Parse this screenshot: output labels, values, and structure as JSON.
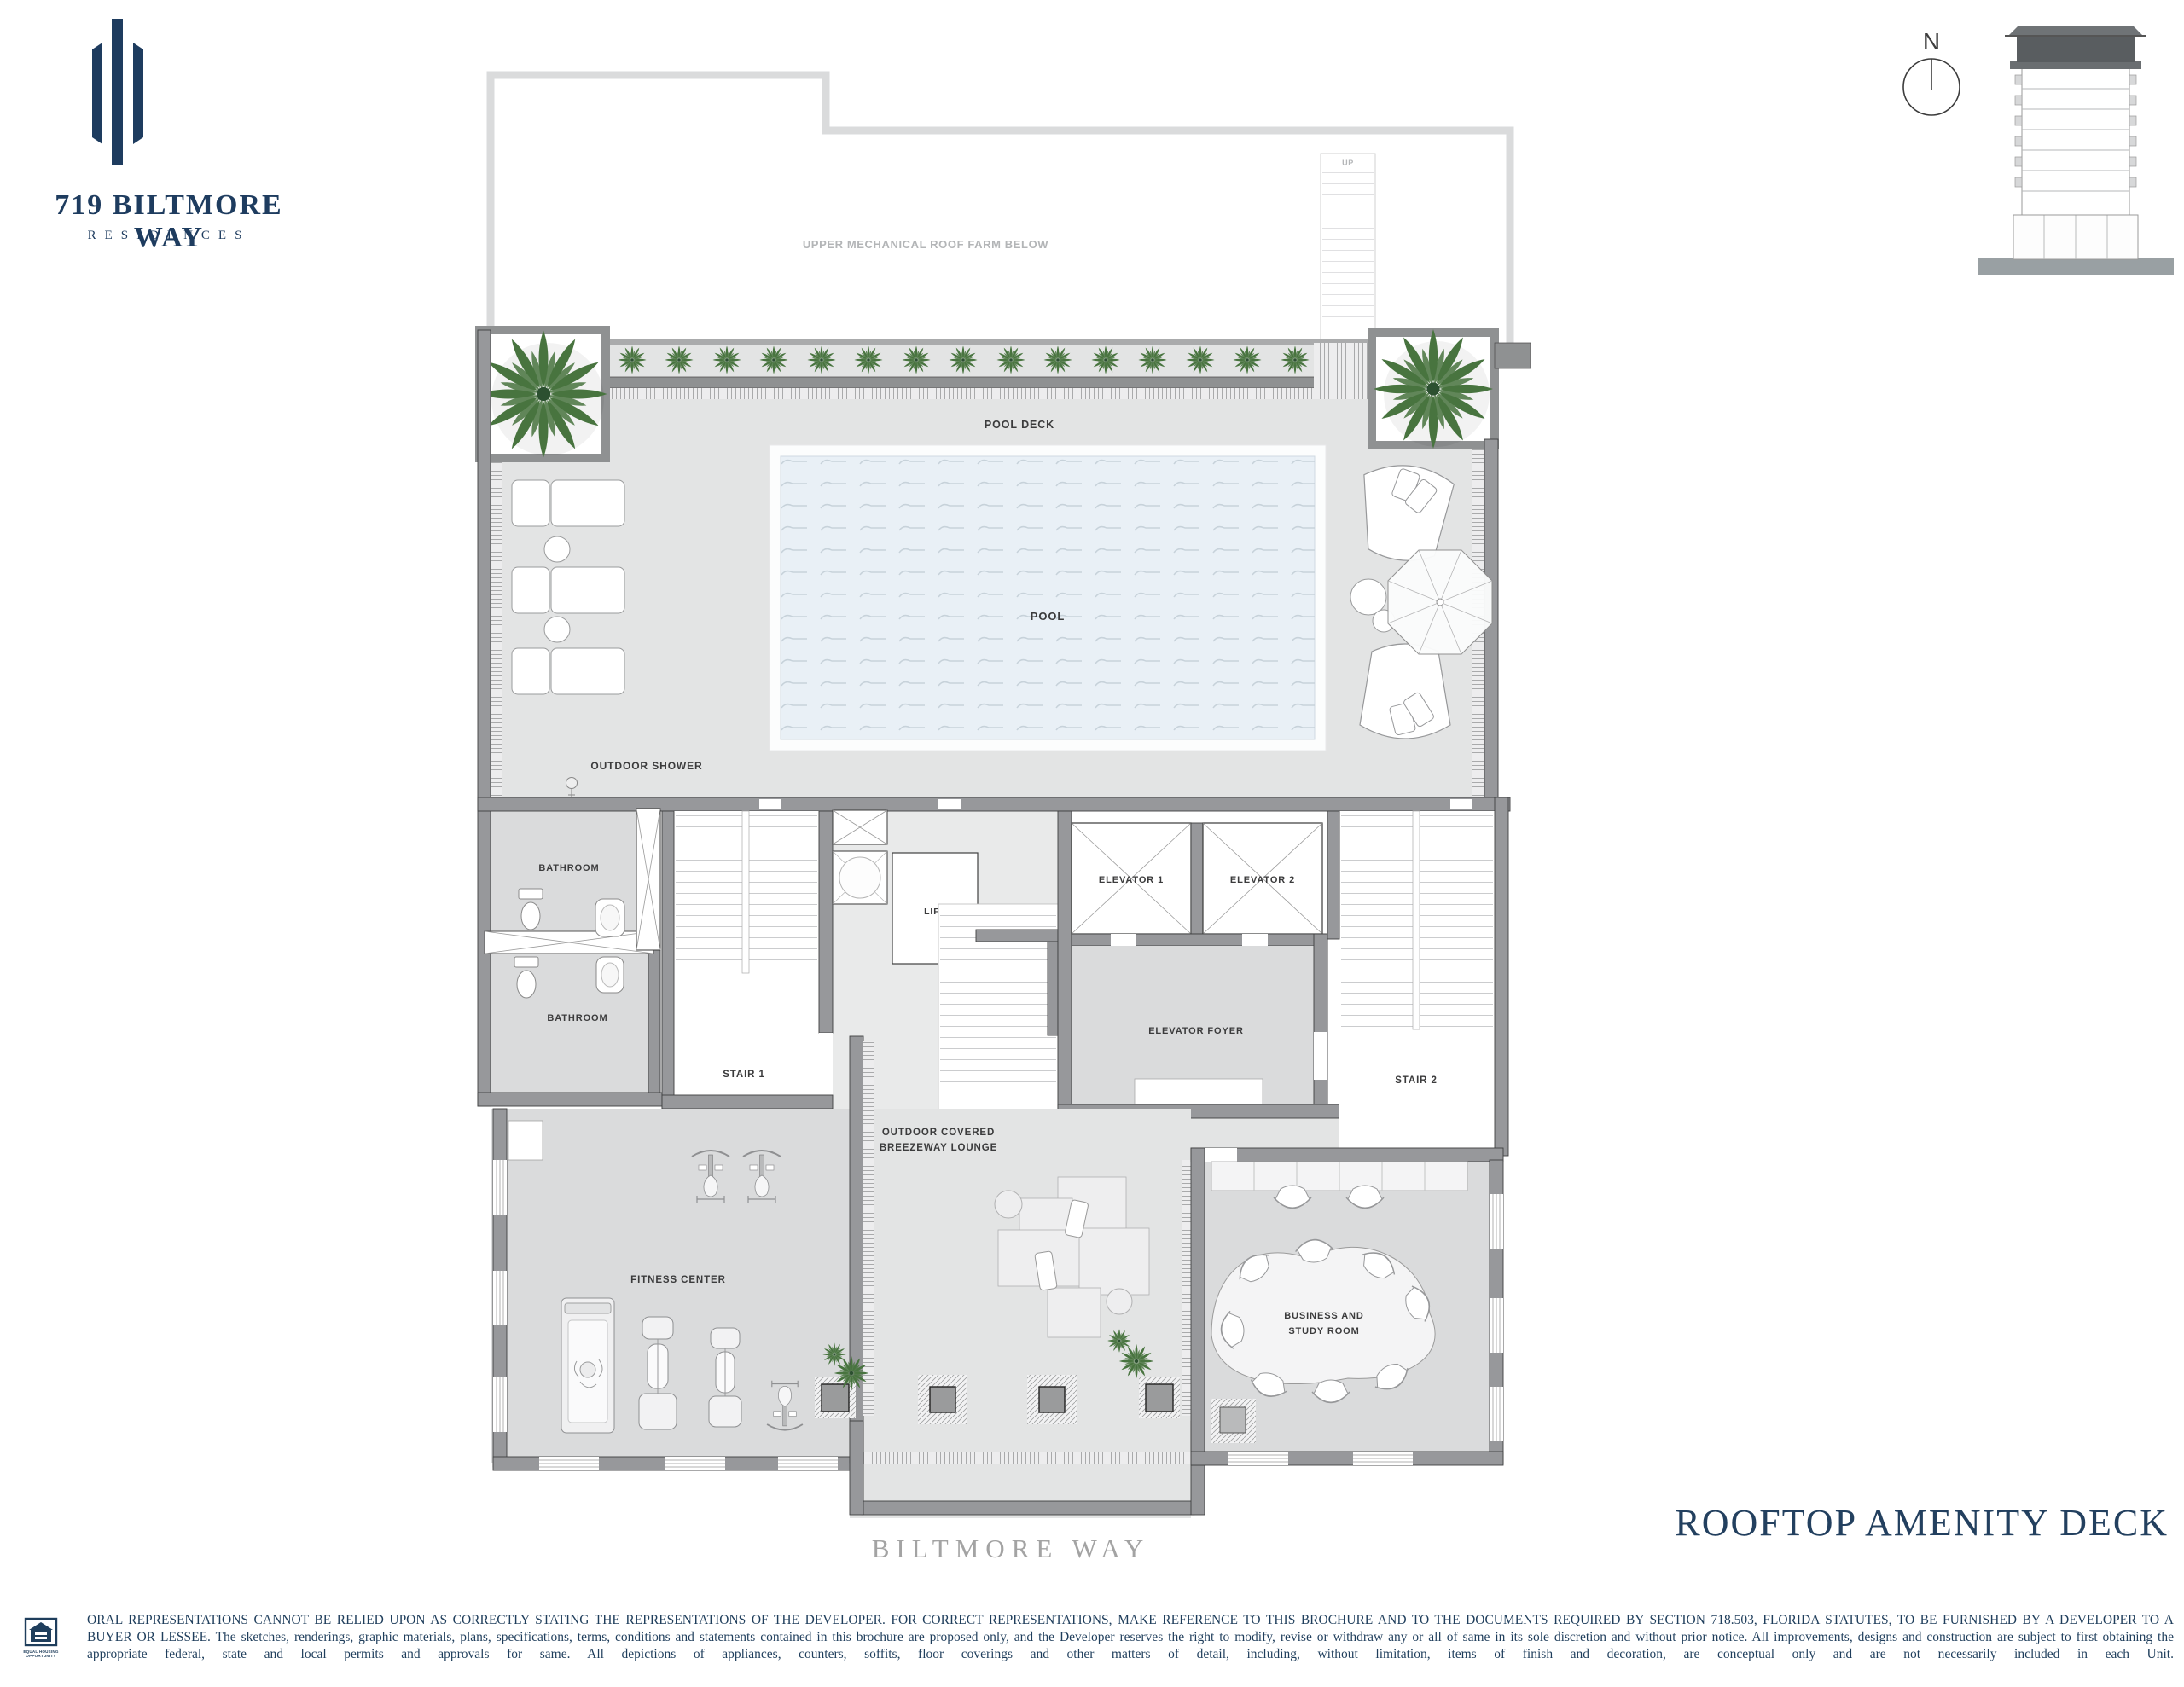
{
  "brand": {
    "name": "719 BILTMORE WAY",
    "subtitle": "RESIDENCES"
  },
  "compass": {
    "label": "N"
  },
  "plan": {
    "labels": {
      "mechanical_roof": "UPPER MECHANICAL ROOF FARM BELOW",
      "up": "UP",
      "pool_deck": "POOL DECK",
      "pool": "POOL",
      "outdoor_shower": "OUTDOOR SHOWER",
      "bathroom_1": "BATHROOM",
      "bathroom_2": "BATHROOM",
      "stair_1": "STAIR 1",
      "lift": "LIFT",
      "elevator_1": "ELEVATOR 1",
      "elevator_2": "ELEVATOR 2",
      "elevator_foyer": "ELEVATOR FOYER",
      "stair_2": "STAIR 2",
      "breezeway_line1": "OUTDOOR COVERED",
      "breezeway_line2": "BREEZEWAY LOUNGE",
      "fitness": "FITNESS CENTER",
      "business_line1": "BUSINESS AND",
      "business_line2": "STUDY ROOM"
    }
  },
  "street_label": "BILTMORE WAY",
  "page_title": "ROOFTOP AMENITY DECK",
  "disclaimer": {
    "line1": "ORAL REPRESENTATIONS CANNOT BE RELIED UPON AS CORRECTLY STATING THE REPRESENTATIONS OF THE DEVELOPER.  FOR CORRECT REPRESENTATIONS, MAKE REFERENCE TO THIS BROCHURE AND TO THE DOCUMENTS REQUIRED BY SECTION 718.503, FLORIDA STATUTES, TO BE FURNISHED BY A DEVELOPER TO A",
    "line2": "BUYER OR LESSEE. The sketches, renderings, graphic materials, plans, specifications, terms, conditions and statements contained in this brochure are proposed only, and the Developer reserves the right to modify, revise or withdraw any or all of same in its sole discretion and without prior notice.  All improvements, designs and construction are subject to first obtaining the",
    "line3": "appropriate federal, state and local permits and approvals for same.  All depictions of appliances, counters, soffits, floor coverings and other matters of detail, including, without limitation, items of finish and decoration, are conceptual only and are not necessarily included in each Unit."
  },
  "equal_housing": {
    "line1": "EQUAL HOUSING",
    "line2": "OPPORTUNITY"
  },
  "colors": {
    "navy": "#1e3c5f",
    "wall_gray": "#97989b",
    "room_gray": "#dadbdc",
    "deck_gray": "#e3e4e4",
    "pool_blue": "#e9f0f6",
    "plant_green": "#48743f",
    "street_gray": "#a3a3a3"
  }
}
